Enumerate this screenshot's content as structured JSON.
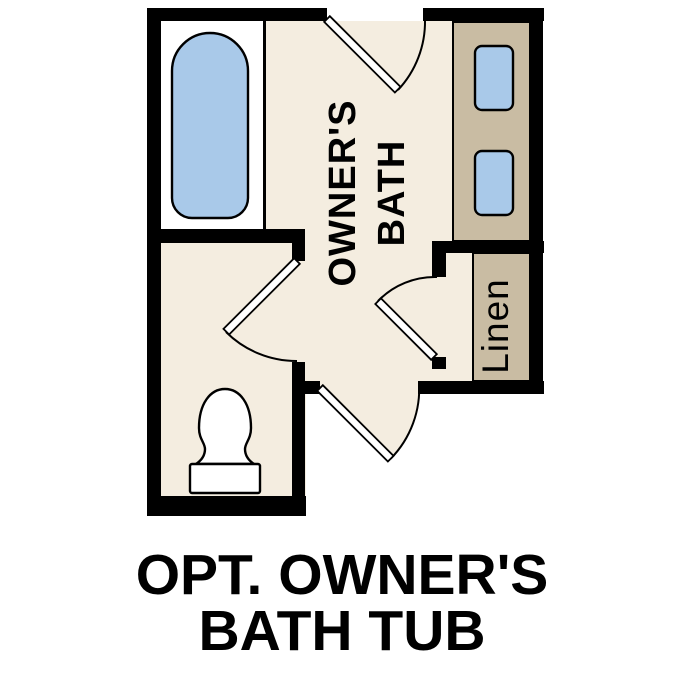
{
  "plan": {
    "room_label_line1": "OWNER'S",
    "room_label_line2": "BATH",
    "closet_label": "Linen",
    "caption_line1": "OPT. OWNER'S",
    "caption_line2": "BATH TUB"
  },
  "colors": {
    "wall": "#000000",
    "floor": "#f4ede0",
    "tub_room_floor": "#ffffff",
    "fixture_white": "#ffffff",
    "water_blue": "#a9c9e9",
    "cabinet_tan": "#c9bca3",
    "outline": "#000000",
    "text": "#000000"
  }
}
